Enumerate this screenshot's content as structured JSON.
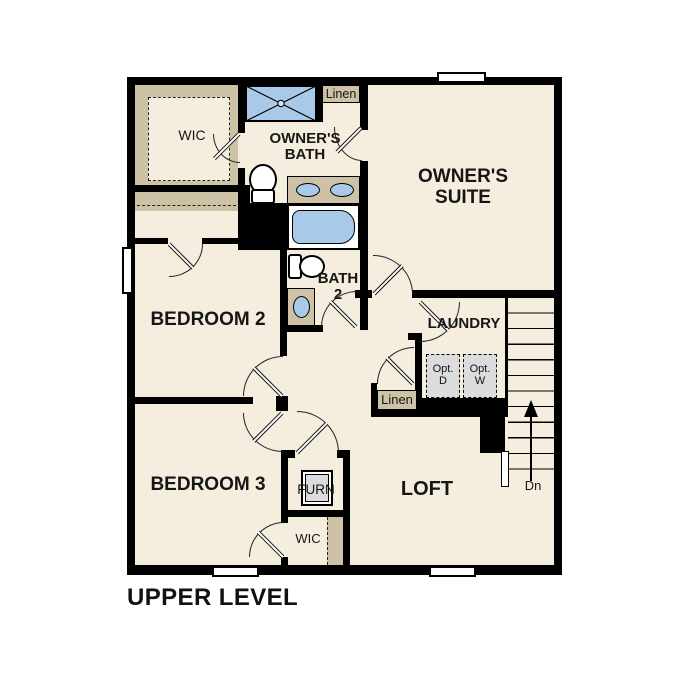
{
  "title": {
    "text": "UPPER LEVEL"
  },
  "rooms": {
    "wic_owner": {
      "label": "WIC"
    },
    "owners_bath": {
      "label": "OWNER'S BATH"
    },
    "linen_top": {
      "label": "Linen"
    },
    "owners_suite": {
      "label": "OWNER'S SUITE"
    },
    "bedroom_2": {
      "label": "BEDROOM 2"
    },
    "bath_2": {
      "label": "BATH 2"
    },
    "laundry": {
      "label": "LAUNDRY"
    },
    "opt_dryer": {
      "line1": "Opt.",
      "line2": "D"
    },
    "opt_washer": {
      "line1": "Opt.",
      "line2": "W"
    },
    "linen_hall": {
      "label": "Linen"
    },
    "bedroom_3": {
      "label": "BEDROOM 3"
    },
    "furnace": {
      "label": "FURN"
    },
    "loft": {
      "label": "LOFT"
    },
    "wic_bedroom_3": {
      "label": "WIC"
    },
    "stairs_down": {
      "label": "Dn"
    }
  },
  "colors": {
    "floor": "#f5eede",
    "wall": "#000000",
    "shelving_tan": "#cec2a6",
    "fixture_blue": "#a9c9e9",
    "optional_gray": "#dcdcdc",
    "window_white": "#ffffff"
  }
}
